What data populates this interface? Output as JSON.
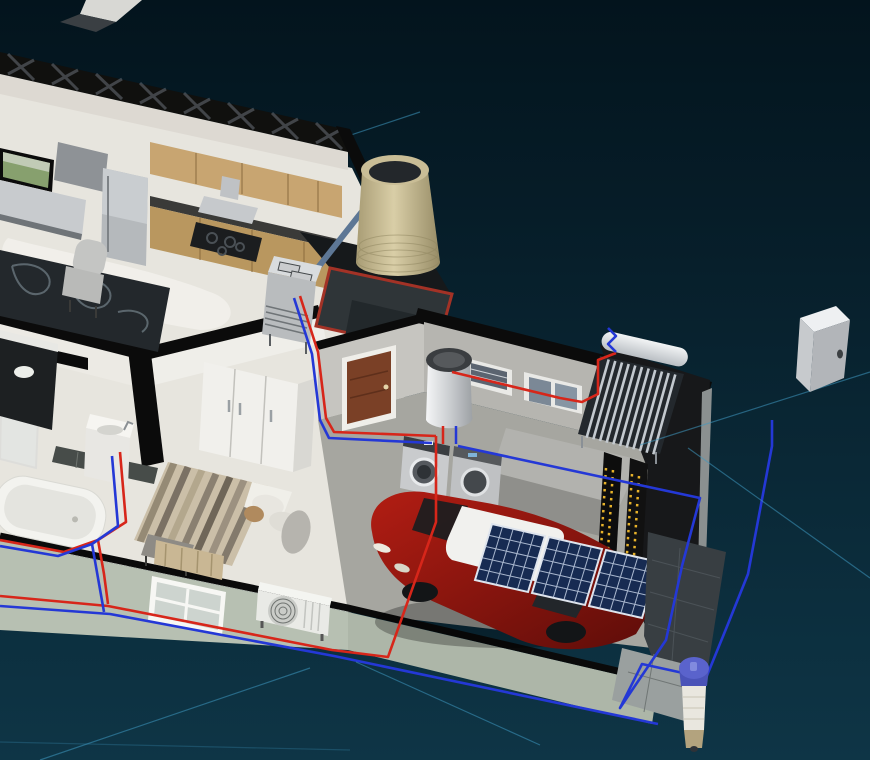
{
  "scene": {
    "label": "3D isometric cutaway of a house showing solar energy, hot and cold water systems",
    "palette": {
      "bg_top": "#03141d",
      "bg_bottom": "#0e3546",
      "grid_line": "#3f98c0",
      "pipe_hot": "#d7261a",
      "pipe_cold": "#2438d6",
      "steel_pipe": "#5d7795",
      "trim_red": "#a33226",
      "tank_tan": "#c9bd96",
      "panel_blue": "#172b52",
      "panel_grid": "#c3d0e4",
      "car_red": "#9c1712",
      "battery_yellow": "#e8b32a",
      "wood_cabinet": "#c8a571",
      "wood_door": "#7a4026",
      "exterior_sage": "#b7c0b2",
      "concrete": "#a6a6a0",
      "floor_cream": "#e7e5de",
      "wall_top_black": "#0b0b0b",
      "wall_white": "#efeee9",
      "stainless": "#c6c9cc",
      "collector_dark": "#23282d",
      "filter_cap_blue": "#5a63cc"
    },
    "objects": [
      {
        "id": "roof-truss",
        "label": "Cutaway roof truss"
      },
      {
        "id": "tv",
        "label": "Wall TV"
      },
      {
        "id": "island-hood",
        "label": "Stainless island hood"
      },
      {
        "id": "media-cabinet",
        "label": "Steel cabinet"
      },
      {
        "id": "fridge",
        "label": "Stainless refrigerator"
      },
      {
        "id": "upper-cabinets",
        "label": "Kitchen upper cabinets"
      },
      {
        "id": "lower-cabinets",
        "label": "Kitchen lower cabinets"
      },
      {
        "id": "cooktop",
        "label": "Cooktop"
      },
      {
        "id": "range-hood",
        "label": "Range hood"
      },
      {
        "id": "area-rug",
        "label": "Living room rug"
      },
      {
        "id": "armchair",
        "label": "Armchair"
      },
      {
        "id": "bathroom-vanity",
        "label": "Dark vanity"
      },
      {
        "id": "shower",
        "label": "Glass shower"
      },
      {
        "id": "tile-ledge",
        "label": "Tiled ledge"
      },
      {
        "id": "bathroom-sink",
        "label": "Bathroom sink"
      },
      {
        "id": "bathtub",
        "label": "Bathtub"
      },
      {
        "id": "bedroom-wardrobe",
        "label": "White wardrobe"
      },
      {
        "id": "bed",
        "label": "Bed with striped duvet"
      },
      {
        "id": "bed-bench",
        "label": "Foot bench"
      },
      {
        "id": "curtain",
        "label": "Bedroom curtain"
      },
      {
        "id": "bedroom-window",
        "label": "Bedroom window"
      },
      {
        "id": "interior-door",
        "label": "Wooden garage door"
      },
      {
        "id": "water-heater",
        "label": "Wall mounted water heater"
      },
      {
        "id": "washing-machine",
        "label": "Washing machine"
      },
      {
        "id": "dryer",
        "label": "Dryer"
      },
      {
        "id": "utility-cabinet",
        "label": "Utility cabinet"
      },
      {
        "id": "garage-window-1",
        "label": "Garage window"
      },
      {
        "id": "garage-window-2",
        "label": "Garage window"
      },
      {
        "id": "car",
        "label": "Red car"
      },
      {
        "id": "solar-panel-1",
        "label": "Photovoltaic panel"
      },
      {
        "id": "solar-panel-2",
        "label": "Photovoltaic panel"
      },
      {
        "id": "solar-panel-3",
        "label": "Photovoltaic panel"
      },
      {
        "id": "battery-bank",
        "label": "Battery bank"
      },
      {
        "id": "solar-water-heater",
        "label": "Evacuated tube solar water heater"
      },
      {
        "id": "rainwater-tank",
        "label": "Rainwater storage tank"
      },
      {
        "id": "deck-platform",
        "label": "Red trimmed deck platform"
      },
      {
        "id": "deck-appliance",
        "label": "Outdoor heat exchange unit"
      },
      {
        "id": "tank-feed-pipe",
        "label": "Tank feed pipe"
      },
      {
        "id": "ac-outdoor-unit",
        "label": "AC outdoor unit"
      },
      {
        "id": "utility-box",
        "label": "Utility box"
      },
      {
        "id": "water-filter",
        "label": "Water filter"
      },
      {
        "id": "walkway",
        "label": "Stone walkway"
      },
      {
        "id": "paver-path",
        "label": "Paver path"
      },
      {
        "id": "hot-water-pipes",
        "label": "Hot water piping"
      },
      {
        "id": "cold-water-pipes",
        "label": "Cold water piping"
      },
      {
        "id": "grid-lines",
        "label": "Background guide lines"
      }
    ]
  }
}
